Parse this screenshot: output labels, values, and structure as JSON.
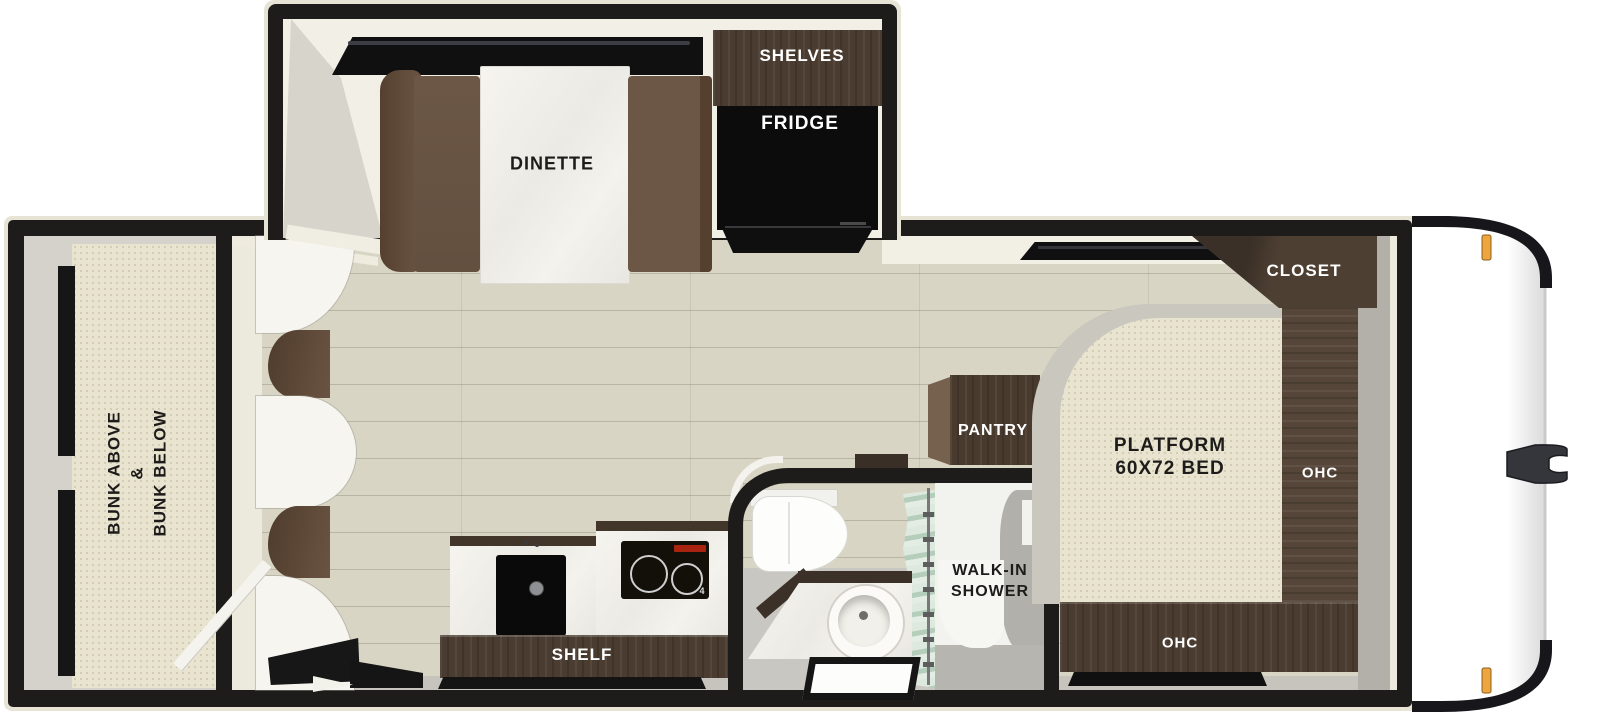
{
  "slideout": {
    "dinette_label": "DINETTE",
    "shelves_label": "SHELVES",
    "fridge_label": "FRIDGE"
  },
  "bunkroom": {
    "label_line1": "BUNK ABOVE",
    "label_line2": "&",
    "label_line3": "BUNK BELOW"
  },
  "kitchen": {
    "shelf_label": "SHELF",
    "cooktop_mark": "4"
  },
  "bathroom": {
    "shower_label_line1": "WALK-IN",
    "shower_label_line2": "SHOWER",
    "pantry_label": "PANTRY"
  },
  "bedroom": {
    "bed_label_line1": "PLATFORM",
    "bed_label_line2": "60X72 BED",
    "closet_label": "CLOSET",
    "ohc_side_label": "OHC",
    "ohc_foot_label": "OHC"
  },
  "colors": {
    "wall": "#1d1c1a",
    "outer_trim": "#e8e4d5",
    "floor": "#d9d5c5",
    "cabinet_wood": "#4a3c30",
    "bench": "#6c5746",
    "bed": "#e9e4d0",
    "marker_light": "#eda63e",
    "shower_curtain": "#bfd4c4",
    "hitch": "#35363c"
  }
}
